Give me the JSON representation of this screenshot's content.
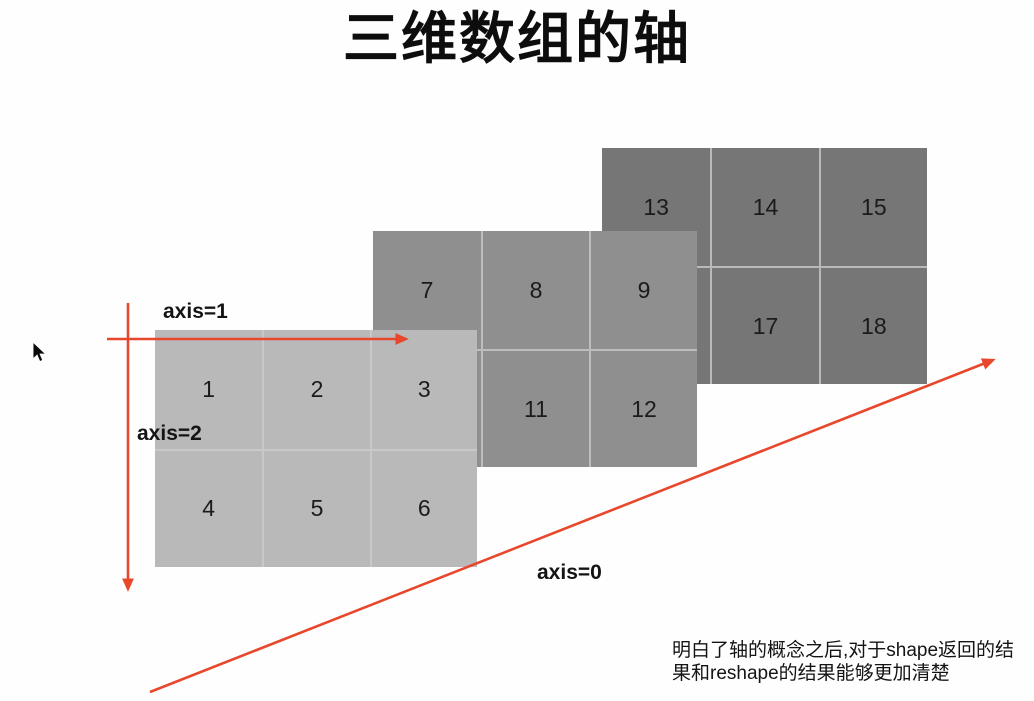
{
  "title": "三维数组的轴",
  "axis_labels": {
    "axis1": "axis=1",
    "axis2": "axis=2",
    "axis0": "axis=0"
  },
  "planes": {
    "front": {
      "values": [
        "1",
        "2",
        "3",
        "4",
        "5",
        "6"
      ]
    },
    "middle": {
      "values": [
        "7",
        "8",
        "9",
        "",
        "11",
        "12"
      ]
    },
    "back": {
      "values": [
        "13",
        "14",
        "15",
        "",
        "17",
        "18"
      ]
    }
  },
  "note": {
    "line1": "明白了轴的概念之后,对于shape返回的结",
    "line2": "果和reshape的结果能够更加清楚"
  },
  "colors": {
    "arrow": "#e8472b",
    "plane_front": "#b9b9b9",
    "plane_middle": "#8f8f8f",
    "plane_back": "#767676",
    "title_text": "#0d0d0d"
  },
  "icons": {
    "cursor": "mouse-pointer"
  }
}
